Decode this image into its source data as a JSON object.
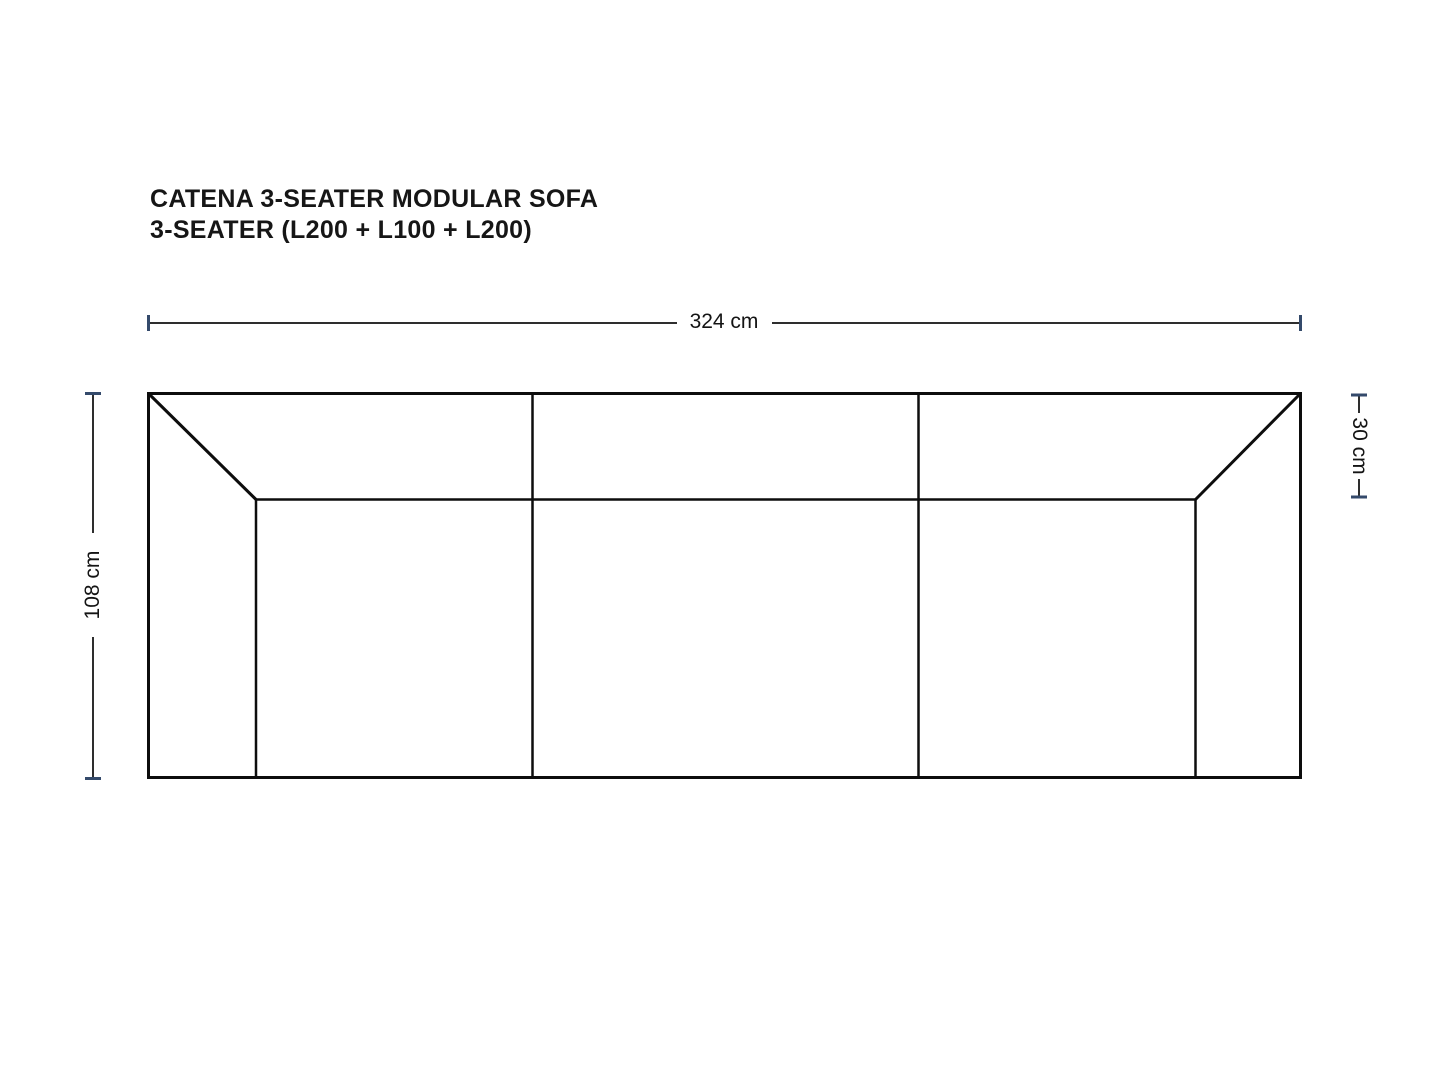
{
  "page": {
    "background_color": "#ffffff"
  },
  "title": {
    "line1": "CATENA 3-SEATER MODULAR SOFA",
    "line2": "3-SEATER (L200 + L100 + L200)"
  },
  "drawing": {
    "module_count": 3
  },
  "dimensions": {
    "width": {
      "label": "324 cm",
      "value_cm": 324
    },
    "depth": {
      "label": "108 cm",
      "value_cm": 108
    },
    "back_depth": {
      "label": "30 cm",
      "value_cm": 30
    }
  },
  "colors": {
    "sofa_line": "#0d0d0d",
    "dimension_line": "#2e2e2e",
    "tick": "#344a6b",
    "text": "#141414"
  }
}
